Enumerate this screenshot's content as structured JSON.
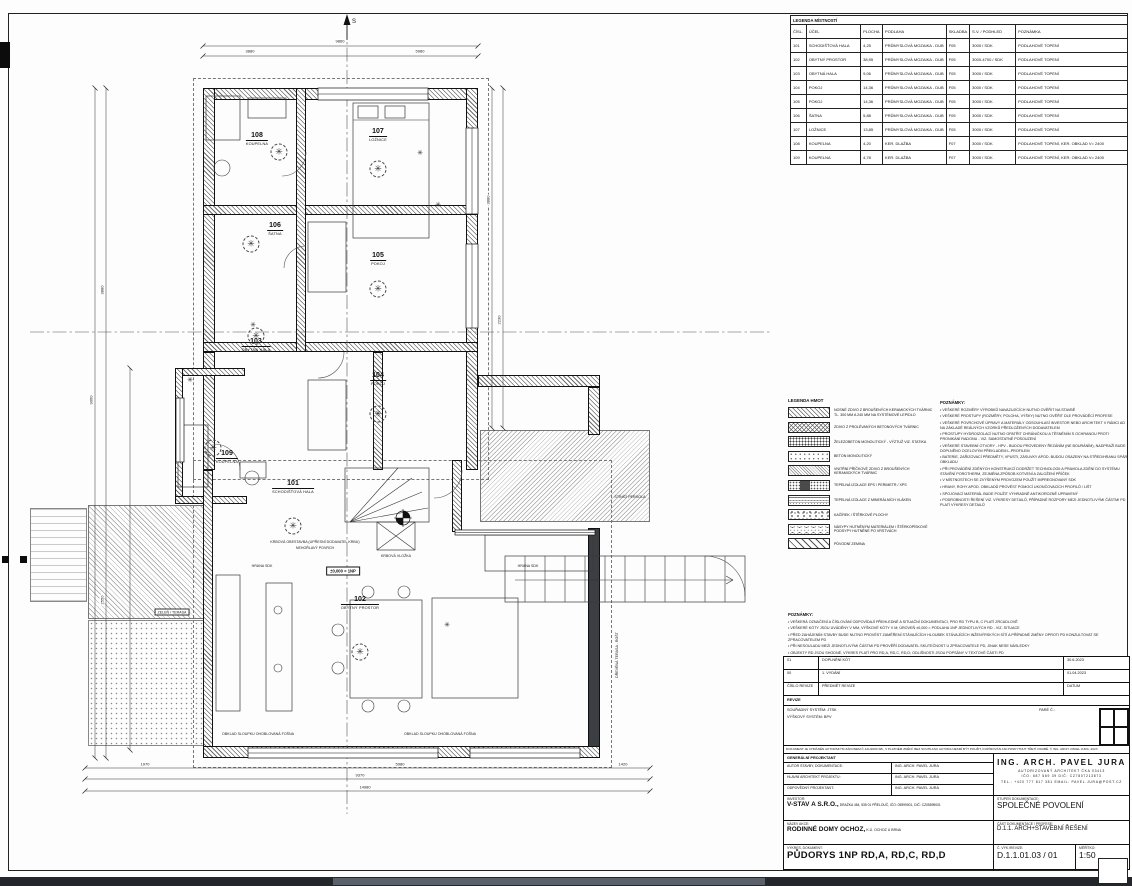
{
  "colors": {
    "line": "#1a1a1a",
    "wall_dark": "#3b3e42",
    "bottom_bar": "#23262b",
    "bottom_bar_light": "#5a616b"
  },
  "room_legend": {
    "title": "LEGENDA MÍSTNOSTÍ",
    "columns": [
      "ČÍSL.",
      "ÚČEL",
      "PLOCHA",
      "PODLAHA",
      "SKLADBA",
      "S.V. / PODHLED",
      "POZNÁMKA"
    ],
    "rows": [
      [
        "101",
        "SCHODIŠŤOVÁ HALA",
        "4,25",
        "PRŮMYSLOVÁ MOZAIKA - DUB",
        "F05",
        "3000 / SDK",
        "PODLAHOVÉ TOPENÍ"
      ],
      [
        "102",
        "OBYTNÝ PROSTOR",
        "38,95",
        "PRŮMYSLOVÁ MOZAIKA - DUB",
        "F05",
        "3000-4700 / SDK",
        "PODLAHOVÉ TOPENÍ"
      ],
      [
        "103",
        "OBYTNÁ HALA",
        "9,06",
        "PRŮMYSLOVÁ MOZAIKA - DUB",
        "F05",
        "3000 / SDK",
        "PODLAHOVÉ TOPENÍ"
      ],
      [
        "104",
        "POKOJ",
        "14,36",
        "PRŮMYSLOVÁ MOZAIKA - DUB",
        "F05",
        "3000 / SDK",
        "PODLAHOVÉ TOPENÍ"
      ],
      [
        "105",
        "POKOJ",
        "14,36",
        "PRŮMYSLOVÁ MOZAIKA - DUB",
        "F05",
        "3000 / SDK",
        "PODLAHOVÉ TOPENÍ"
      ],
      [
        "106",
        "ŠATNA",
        "5,88",
        "PRŮMYSLOVÁ MOZAIKA - DUB",
        "F05",
        "3000 / SDK",
        "PODLAHOVÉ TOPENÍ"
      ],
      [
        "107",
        "LOŽNICE",
        "13,85",
        "PRŮMYSLOVÁ MOZAIKA - DUB",
        "F05",
        "3000 / SDK",
        "PODLAHOVÉ TOPENÍ"
      ],
      [
        "108",
        "KOUPELNA",
        "4,20",
        "KER. DLAŽBA",
        "F07",
        "3000 / SDK",
        "PODLAHOVÉ TOPENÍ, KER. OBKLAD V= 2400"
      ],
      [
        "109",
        "KOUPELNA",
        "4,78",
        "KER. DLAŽBA",
        "F07",
        "3000 / SDK",
        "PODLAHOVÉ TOPENÍ, KER. OBKLAD V= 2400"
      ]
    ]
  },
  "material_legend": {
    "title": "LEGENDA HMOT",
    "items": [
      {
        "hatch": "h-diag",
        "label": "NOSNÉ ZDIVO Z BROUŠENÝCH KERAMICKÝCH TVÁRNIC TL. 300 MM A 240 MM NA SYSTÉMOVÉ LEPIDLO"
      },
      {
        "hatch": "h-cross",
        "label": "ZDIVO Z PROLÉVANÝCH BETONOVÝCH TVÁRNIC"
      },
      {
        "hatch": "h-zb",
        "label": "ŽELEZOBETON MONOLITICKÝ - VÝZTUŽ VIZ. STATIKA"
      },
      {
        "hatch": "h-beton",
        "label": "BETON MONOLITICKÝ"
      },
      {
        "hatch": "h-pricka",
        "label": "VNITŘNÍ PŘÍČKOVÉ ZDIVO Z BROUŠENÝCH KERAMICKÝCH TVÁRNIC"
      },
      {
        "hatch": "h-eps",
        "label": "TEPELNÁ IZOLACE EPS / PERIMETR / XPS"
      },
      {
        "hatch": "h-minvl",
        "label": "TEPELNÁ IZOLACE Z MINERÁLNÍCH VLÁKEN"
      },
      {
        "hatch": "h-kacirek",
        "label": "KAČÍREK / ŠTĚRKOVÉ PLOCHY"
      },
      {
        "hatch": "h-nasyp",
        "label": "NÁSYPY HUTNĚNÝM MATERIÁLEM / ŠTĚRKOPÍSKOVÉ PODSYPY HUTNĚNÉ PO VRSTVÁCH"
      },
      {
        "hatch": "h-zemina",
        "label": "PŮVODNÍ ZEMINA"
      }
    ]
  },
  "notes_right": {
    "title": "POZNÁMKY:",
    "lines": [
      "• VEŠKERÉ ROZMĚRY VÝROBKŮ NAVAZUJÍCÍCH NUTNO OVĚŘIT NA STAVBĚ",
      "• VEŠKERÉ PROSTUPY (ROZMĚRY, POLOHA, VÝŠKY) NUTNO OVĚŘIT DLE PROVÁDĚCÍ PROFESE",
      "• VEŠKERÉ POVRCHOVÉ ÚPRAVY A MATERIÁLY ODSOUHLASÍ INVESTOR NEBO ARCHITEKT V RÁMCI AD NA ZÁKLADĚ REÁLNÝCH VZORKŮ PŘEDLOŽENÝCH DODAVATELEM",
      "• PROSTUPY HYDROIZOLACÍ NUTNO OPATŘIT CHRÁNIČKOU A TĚSNĚNÍM S OCHRANOU PROTI PRONIKÁNÍ RADONU - VIZ. SAMOSTATNÉ POSOUZENÍ",
      "• VEŠKERÉ STAVEBNÍ OTVORY - HPV - BUDOU PROVEDENY ŘEZÁNÍM (NE BOURÁNÍM), NADPRAŽÍ BUDE DOPLNĚNO OCELOVÝM PŘEKLADEM L-PROFILEM",
      "• BATERIE, ZAŘIZOVACÍ PŘEDMĚTY, VPUSTI, ZÁSUVKY APOD. BUDOU OSAZENY NA STŘED/HRANU SPÁR OBKLADU",
      "• PŘI PROVÁDĚNÍ ZDĚNÝCH KONSTRUKCÍ DODRŽET TECHNOLOGII A PRAVIDLA ZDĚNÍ DO SYSTÉMU STAVĚNÍ POROTHERM, ZEJMÉNA ZPŮSOB KOTVENÍ A ZALOŽENÍ PŘÍČEK",
      "• V MÍSTNOSTECH SE ZVÝŠENÝM PROVOZEM POUŽÍT IMPREGNOVANÝ SDK",
      "• HRANY, ROHY APOD. OBKLADŮ PROVÉST POMOCÍ UKONČOVACÍCH PROFILŮ / LIŠT",
      "• SPOJOVACÍ MATERIÁL BUDE POUŽIT VÝHRADNĚ ANTIKOROZNĚ UPRAVENÝ",
      "• PODROBNOSTI ŘEŠENÍ VIZ. VÝKRESY DETAILŮ, PŘÍPADNÉ ROZPORY MEZI JEDNOTLIVÝMI ČÁSTMI PD PLATÍ VÝKRESY DETAILŮ"
    ]
  },
  "notes_mid": {
    "title": "POZNÁMKY:",
    "lines": [
      "• VEŠKERÁ OZNAČENÍ A ČÍSLOVÁNÍ ODPOVÍDAJÍ PŘEHLEDNÉ A SITUAČNÍ DOKUMENTACI, PRO RD TYPU B, C PLATÍ ZRCADLOVĚ",
      "• VEŠKERÉ KÓTY JSOU UVÁDĚNY V MM, VÝŠKOVÉ KÓTY V M; ÚROVEŇ ±0,000 = PODLAHA 1NP JEDNOTLIVÝCH RD - VIZ. SITUACE",
      "• PŘED ZAHÁJENÍM STAVBY BUDE NUTNO PROVÉST ZAMĚŘENÍ STÁVAJÍCÍCH HLOUBEK STÁVAJÍCÍCH INŽENÝRSKÝCH SÍTÍ A PŘÍPADNÉ ZMĚNY OPROTI PD KONZULTOVAT SE ZPRACOVATELEM PD",
      "• PŘI NESOULADU MEZI JEDNOTLIVÝMI ČÁSTMI PD PROVĚŘÍ DODAVATEL SKUTEČNOST U ZPRACOVATELE PD, JINAK NESE NÁSLEDKY",
      "• OBJEKTY RD JSOU SHODNÉ, VÝKRES PLATÍ PRO RD,A, RD,C, RD,D; ODLIŠNOSTI JSOU POPSÁNY V TEXTOVÉ ČÁSTI PD",
      "• ZAŘIZOVACÍ PŘEDMĚTY A VESTAVĚNÝ NÁBYTEK JSOU ZAKRESLENY ORIENTAČNĚ, NEJSOU SOUČÁSTÍ DODÁVKY STAVBY, POKUD NENÍ UVEDENO JINAK"
    ]
  },
  "titleblock": {
    "revisions": [
      {
        "no": "01",
        "subject": "DOPLNĚNÍ KÓT",
        "date": "30.6.2023"
      },
      {
        "no": "00",
        "subject": "1. VYDÁNÍ",
        "date": "01.04.2023"
      }
    ],
    "rev_header": {
      "no": "ČÍSLO REVIZE",
      "subject": "PŘEDMĚT REVIZE",
      "date": "DATUM"
    },
    "revize_label": "REVIZE",
    "coord_system": "SOUŘADNÝ SYSTÉM:    JTSK",
    "height_system": "VÝŠKOVÝ SYSTÉM:    BPV",
    "pare_label": "PARÉ Č.:",
    "copyright": "DOKUMENT JE CHRÁNĚN AUTORSKÝM ZÁKONEM Č.121/2000 SB., V PLATNÉM ZNĚNÍ. BEZ SOUHLASU AUTORA NESMÍ BÝT POUŽIT, KOPÍROVÁN ANI POSKYTNUT TŘETÍ OSOBĚ. © ING. ARCH. PAVEL JURA, 2023",
    "general_label": "GENERÁLNÍ PROJEKTANT",
    "roles": [
      {
        "label": "AUTOR STAVBY, DOKUMENTACE:",
        "value": "ING. ARCH. PAVEL JURA"
      },
      {
        "label": "HLAVNÍ ARCHITEKT PROJEKTU:",
        "value": "ING. ARCH. PAVEL JURA"
      },
      {
        "label": "ODPOVĚDNÝ PROJEKTANT:",
        "value": "ING. ARCH. PAVEL JURA"
      }
    ],
    "architect": {
      "name": "ING. ARCH. PAVEL JURA",
      "line1": "AUTORIZOVANÝ ARCHITEKT ČKA 03413",
      "line2": "IČO: 687 569 39      DIČ: CZ7807213873",
      "line3": "TEL.: +420 777 817 381   EMAIL: PAVEL.JURA@POST.CZ"
    },
    "investor_label": "INVESTOR:",
    "investor": "V-STAV A S.R.O.,",
    "investor_detail": "DRAŽKA 454, 535 01 PŘELOUČ, IČO: 05599001, DIČ: CZ05599001",
    "stupen_label": "STUPEŇ DOKUMENTACE:",
    "stupen": "SPOLEČNÉ POVOLENÍ",
    "akce_label": "NÁZEV AKCE:",
    "akce": "RODINNÉ DOMY OCHOZ,",
    "akce_detail": "K.Ú. OCHOZ U BRNA",
    "cast_label": "ČÁST DOKUMENTACE / PROFESE:",
    "cast": "D.1.1. ARCH+STAVEBNÍ ŘEŠENÍ",
    "vykres_label": "VÝKRES, DOKUMENT:",
    "vykres": "PŮDORYS 1NP RD,A, RD,C, RD,D",
    "cislo_label": "Č. VÝK./REVIZE:",
    "cislo": "D.1.1.01.03 / 01",
    "meritko_label": "MĚŘÍTKO:",
    "meritko": "1:50"
  },
  "plan": {
    "level_label": "±0,000 = 1NP",
    "north_label": "S",
    "rooms": [
      {
        "num": "101",
        "name": "SCHODIŠŤOVÁ HALA",
        "x": 293,
        "y": 480,
        "sym": [
          0,
          32
        ]
      },
      {
        "num": "102",
        "name": "OBYTNÝ PROSTOR",
        "x": 360,
        "y": 596,
        "sym": [
          0,
          42
        ]
      },
      {
        "num": "103",
        "name": "OBYTNÁ HALA",
        "x": 256,
        "y": 338,
        "sym": [
          0,
          -16
        ]
      },
      {
        "num": "104",
        "name": "POKOJ",
        "x": 378,
        "y": 372,
        "sym": [
          0,
          28
        ]
      },
      {
        "num": "105",
        "name": "POKOJ",
        "x": 378,
        "y": 252,
        "sym": [
          0,
          23
        ]
      },
      {
        "num": "106",
        "name": "ŠATNA",
        "x": 275,
        "y": 222,
        "sym": [
          -24,
          8
        ]
      },
      {
        "num": "107",
        "name": "LOŽNICE",
        "x": 378,
        "y": 128,
        "sym": [
          0,
          27
        ]
      },
      {
        "num": "108",
        "name": "KOUPELNA",
        "x": 257,
        "y": 132,
        "sym": [
          22,
          6
        ]
      },
      {
        "num": "109",
        "name": "KOUPELNA",
        "x": 227,
        "y": 450,
        "sym": [
          -14,
          -16
        ]
      }
    ],
    "symbols": [
      {
        "x": 420,
        "y": 153
      },
      {
        "x": 438,
        "y": 205
      },
      {
        "x": 253,
        "y": 325
      },
      {
        "x": 190,
        "y": 380
      },
      {
        "x": 447,
        "y": 625
      }
    ],
    "annotations": [
      {
        "x": 315,
        "y": 542,
        "t": "KRBOVÁ OBESTAVBA (UPŘESNÍ DODAVATEL KRBU)"
      },
      {
        "x": 315,
        "y": 548,
        "t": "NEHOŘLAVÝ POVRCH"
      },
      {
        "x": 396,
        "y": 556,
        "t": "KRBOVÁ VLOŽKA"
      },
      {
        "x": 262,
        "y": 566,
        "t": "HRANA SDK"
      },
      {
        "x": 528,
        "y": 566,
        "t": "HRANA SDK"
      },
      {
        "x": 258,
        "y": 734,
        "t": "OBKLAD SLOUPKU OHOBLOVANÁ FOŠNA"
      },
      {
        "x": 440,
        "y": 734,
        "t": "OBKLAD SLOUPKU OHOBLOVANÁ FOŠNA"
      },
      {
        "x": 172,
        "y": 612,
        "t": "ZELEŇ / TERASA",
        "boxed": true
      },
      {
        "x": 617,
        "y": 655,
        "t": "DŘEVĚNÁ TERASA - ROŠT",
        "vert": true
      },
      {
        "x": 630,
        "y": 497,
        "t": "STÍNÍCÍ PERGOLA",
        "vert": false
      }
    ],
    "dim_labels": [
      {
        "x": 340,
        "y": 41,
        "t": "9860"
      },
      {
        "x": 250,
        "y": 51,
        "t": "3880"
      },
      {
        "x": 420,
        "y": 51,
        "t": "5980"
      },
      {
        "x": 145,
        "y": 764,
        "t": "1970"
      },
      {
        "x": 400,
        "y": 764,
        "t": "5980"
      },
      {
        "x": 623,
        "y": 764,
        "t": "1420"
      },
      {
        "x": 360,
        "y": 775,
        "t": "9370"
      },
      {
        "x": 365,
        "y": 787,
        "t": "14980"
      },
      {
        "x": 91,
        "y": 400,
        "t": "9060",
        "v": true
      },
      {
        "x": 102,
        "y": 290,
        "t": "3880",
        "v": true
      },
      {
        "x": 102,
        "y": 600,
        "t": "2550",
        "v": true
      },
      {
        "x": 488,
        "y": 200,
        "t": "3880",
        "v": true
      },
      {
        "x": 499,
        "y": 320,
        "t": "2230",
        "v": true
      }
    ],
    "walls": [
      [
        203,
        88,
        275,
        12
      ],
      [
        466,
        88,
        12,
        382
      ],
      [
        203,
        88,
        12,
        264
      ],
      [
        203,
        352,
        12,
        118
      ],
      [
        203,
        205,
        275,
        10
      ],
      [
        203,
        342,
        275,
        10
      ],
      [
        296,
        88,
        10,
        264
      ],
      [
        373,
        352,
        10,
        118
      ],
      [
        175,
        368,
        70,
        8
      ],
      [
        175,
        368,
        8,
        136
      ],
      [
        175,
        496,
        72,
        8
      ],
      [
        478,
        375,
        122,
        12
      ],
      [
        588,
        387,
        12,
        48
      ],
      [
        588,
        528,
        12,
        230,
        "wall-dark"
      ],
      [
        203,
        470,
        10,
        288
      ],
      [
        203,
        746,
        397,
        12
      ],
      [
        452,
        460,
        10,
        72
      ]
    ],
    "regions": [
      [
        88,
        505,
        118,
        114,
        "deck"
      ],
      [
        88,
        620,
        118,
        126,
        "stipple"
      ],
      [
        480,
        430,
        170,
        92,
        "deck2"
      ],
      [
        30,
        508,
        57,
        94,
        "pergola"
      ],
      [
        193,
        78,
        296,
        402,
        "dashbox"
      ],
      [
        193,
        460,
        419,
        308,
        "dashbox"
      ]
    ],
    "svg": {
      "axes": [
        [
          30,
          332,
          772,
          332
        ],
        [
          347,
          25,
          347,
          814
        ]
      ],
      "dimlines": [
        [
          203,
          46,
          478,
          46
        ],
        [
          203,
          56,
          478,
          56
        ],
        [
          85,
          768,
          650,
          768
        ],
        [
          85,
          779,
          650,
          779
        ],
        [
          85,
          791,
          650,
          791
        ],
        [
          95,
          88,
          95,
          758
        ],
        [
          106,
          88,
          106,
          758
        ],
        [
          492,
          88,
          492,
          428
        ],
        [
          503,
          88,
          503,
          428
        ],
        [
          130,
          368,
          130,
          750
        ]
      ],
      "lines": [
        [
          525,
          556,
          525,
          602
        ],
        [
          545,
          556,
          545,
          602
        ],
        [
          565,
          556,
          565,
          602
        ],
        [
          585,
          556,
          585,
          602
        ],
        [
          605,
          556,
          605,
          602
        ],
        [
          625,
          556,
          625,
          602
        ],
        [
          645,
          556,
          645,
          602
        ],
        [
          665,
          556,
          665,
          602
        ],
        [
          685,
          556,
          685,
          602
        ],
        [
          705,
          556,
          705,
          602
        ],
        [
          725,
          556,
          725,
          602
        ],
        [
          515,
          580,
          733,
          580
        ],
        [
          726,
          576,
          733,
          580
        ],
        [
          726,
          584,
          733,
          580
        ],
        [
          350,
          522,
          398,
          468
        ],
        [
          350,
          522,
          412,
          478
        ],
        [
          350,
          522,
          422,
          492
        ],
        [
          350,
          522,
          428,
          508
        ],
        [
          377,
          522,
          415,
          550
        ],
        [
          377,
          550,
          415,
          522
        ],
        [
          353,
          120,
          429,
          120
        ]
      ],
      "paths": [
        "M306 152 A24 24 0 0 1 282 176",
        "M306 246 A22 22 0 0 0 284 268",
        "M344 352 A26 26 0 0 1 318 378",
        "M240 470 A26 26 0 0 0 214 444",
        "M462 470 A28 28 0 0 1 434 498",
        "M705 556 A40 40 0 0 1 745 596"
      ],
      "rects": [
        [
          353,
          103,
          76,
          135
        ],
        [
          358,
          106,
          20,
          12
        ],
        [
          385,
          106,
          20,
          12
        ],
        [
          308,
          222,
          38,
          70
        ],
        [
          308,
          380,
          38,
          70
        ],
        [
          206,
          96,
          34,
          44
        ],
        [
          248,
          98,
          38,
          20
        ],
        [
          178,
          425,
          30,
          62
        ],
        [
          240,
          462,
          26,
          16
        ],
        [
          216,
          575,
          24,
          136
        ],
        [
          266,
          583,
          26,
          128
        ],
        [
          350,
          600,
          72,
          98
        ],
        [
          432,
          598,
          86,
          100
        ],
        [
          485,
          535,
          108,
          36
        ],
        [
          377,
          522,
          38,
          28
        ],
        [
          505,
          556,
          240,
          46
        ],
        [
          345,
          468,
          84,
          54
        ]
      ],
      "circles": [
        [
          222,
          168,
          8
        ],
        [
          252,
          478,
          7
        ],
        [
          278,
          610,
          4
        ],
        [
          278,
          668,
          4
        ],
        [
          368,
          592,
          6
        ],
        [
          404,
          592,
          6
        ],
        [
          368,
          706,
          6
        ],
        [
          404,
          706,
          6
        ],
        [
          338,
          630,
          6
        ],
        [
          338,
          668,
          6
        ]
      ],
      "windows": [
        [
          318,
          88,
          110,
          12,
          1
        ],
        [
          466,
          128,
          12,
          86,
          0
        ],
        [
          466,
          244,
          12,
          84,
          0
        ],
        [
          176,
          398,
          8,
          64,
          0
        ],
        [
          248,
          748,
          190,
          10,
          1
        ],
        [
          470,
          748,
          110,
          10,
          1
        ],
        [
          455,
          530,
          140,
          5,
          1
        ]
      ]
    }
  },
  "marks": {
    "target_symbol": "section-target",
    "north": "S"
  }
}
